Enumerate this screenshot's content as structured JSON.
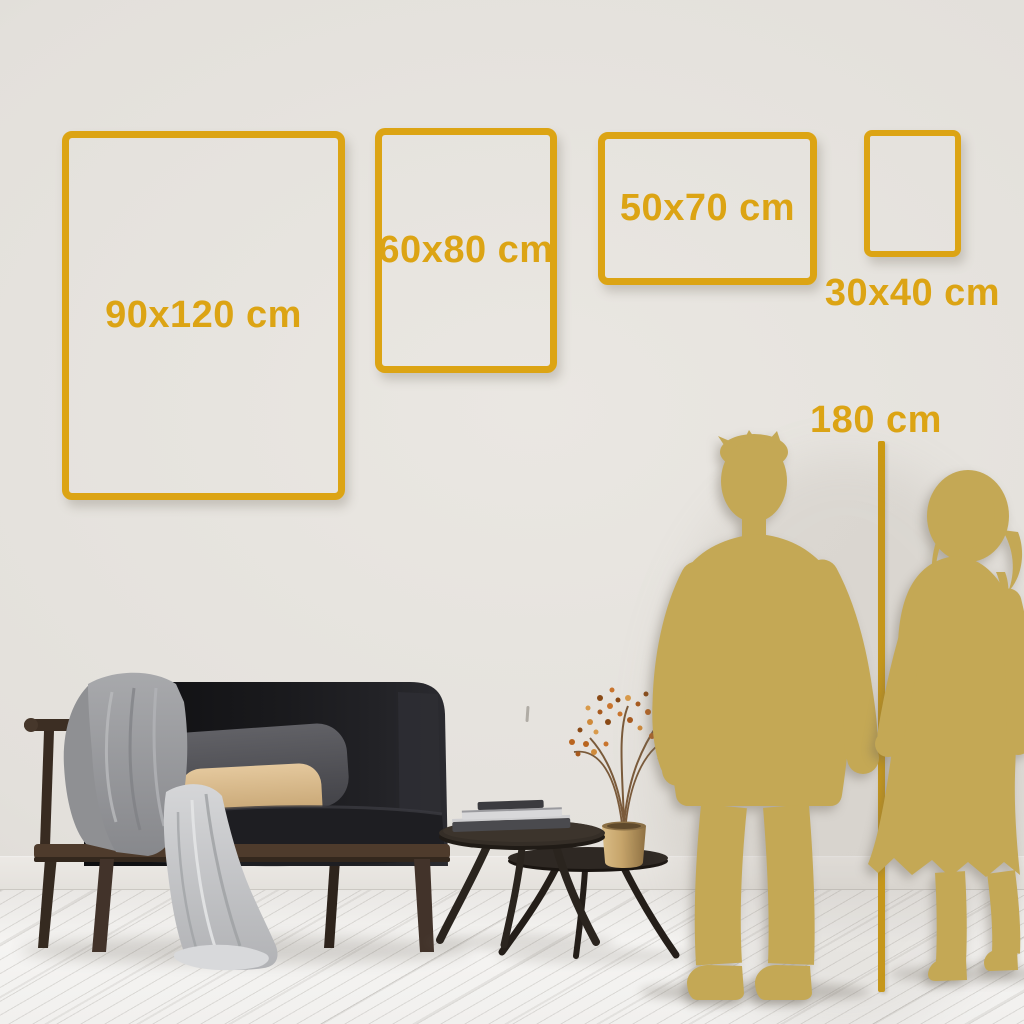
{
  "size_guide": {
    "frames": [
      {
        "id": "90x120",
        "label": "90x120 cm"
      },
      {
        "id": "60x80",
        "label": "60x80 cm"
      },
      {
        "id": "50x70",
        "label": "50x70 cm"
      },
      {
        "id": "30x40",
        "label": "30x40 cm"
      }
    ],
    "height_reference": {
      "label": "180 cm"
    }
  },
  "palette": {
    "accent_gold": "#DCA414",
    "ruler_gold": "#CE9A0E",
    "silhouette_gold": "#C4A855",
    "wall": "#E3E0DB",
    "floor": "#F1F0EE"
  },
  "scene": {
    "objects": [
      "wall",
      "baseboard",
      "wood-floor",
      "sofa",
      "gray-blanket",
      "white-drape",
      "gray-pillow",
      "tan-pillow",
      "nesting-coffee-tables",
      "book-stack",
      "gold-vase",
      "dried-branch",
      "man-silhouette",
      "woman-silhouette",
      "height-ruler-line"
    ]
  }
}
